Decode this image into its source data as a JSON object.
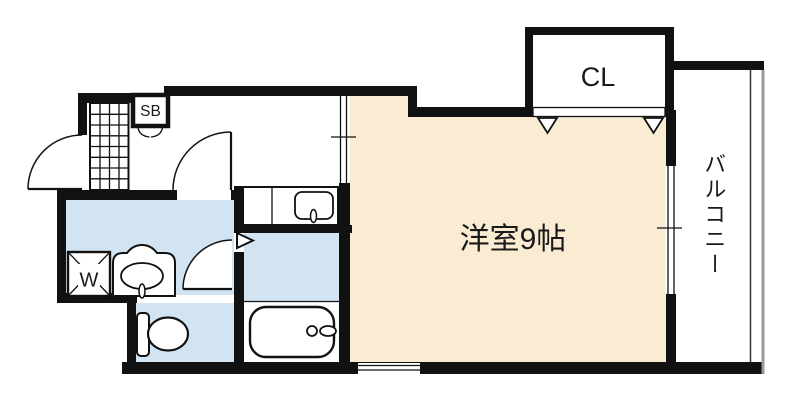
{
  "plan": {
    "title": "floor-plan-1k-apartment",
    "labels": {
      "main_room": "洋室9帖",
      "closet": "CL",
      "shoe_box": "SB",
      "washer": "W",
      "balcony": "バルコニー"
    },
    "colors": {
      "room_fill": "#FAECD3",
      "wet_fill": "#D2E4F1",
      "wall": "#111111",
      "railing": "#9A9A9A",
      "background": "#FFFFFF"
    }
  }
}
